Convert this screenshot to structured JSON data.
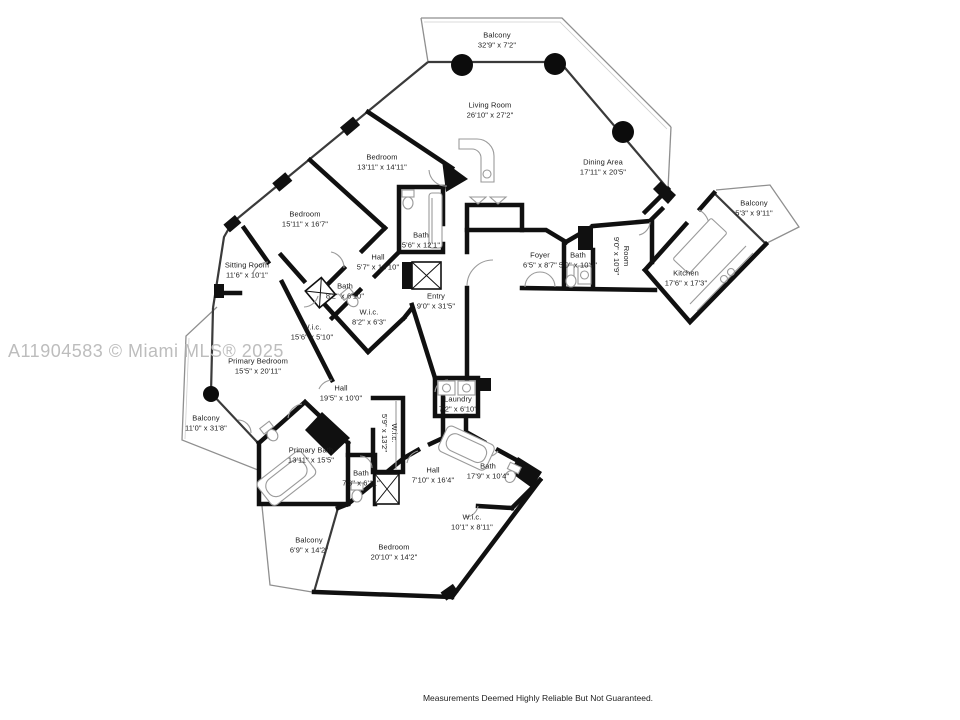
{
  "watermark": "A11904583 © Miami MLS® 2025",
  "disclaimer": "Measurements Deemed Highly Reliable But Not Guaranteed.",
  "colors": {
    "wall": "#101010",
    "window": "#3a3a3a",
    "railing": "#8f8f8f",
    "fixture": "#9a9a9a",
    "watermark": "#bdbdbd"
  },
  "rooms": [
    {
      "name": "Balcony",
      "dims": "32'9\" x 7'2\""
    },
    {
      "name": "Living Room",
      "dims": "26'10\" x 27'2\""
    },
    {
      "name": "Dining Area",
      "dims": "17'11\" x 20'5\""
    },
    {
      "name": "Bedroom",
      "dims": "13'11\" x 14'11\""
    },
    {
      "name": "Bedroom",
      "dims": "15'11\" x 16'7\""
    },
    {
      "name": "Bath",
      "dims": "5'6\" x 12'1\""
    },
    {
      "name": "Hall",
      "dims": "5'7\" x 13'10\""
    },
    {
      "name": "Sitting Room",
      "dims": "11'6\" x 10'1\""
    },
    {
      "name": "Bath",
      "dims": "8'2\" x 6'10\""
    },
    {
      "name": "W.i.c.",
      "dims": "8'2\" x 6'3\""
    },
    {
      "name": "W.i.c.",
      "dims": "15'6\" x 5'10\""
    },
    {
      "name": "Foyer",
      "dims": "6'5\" x 8'7\""
    },
    {
      "name": "Bath",
      "dims": "5'0\" x 10'9\""
    },
    {
      "name": "Room",
      "dims": "9'0\" x 10'9\""
    },
    {
      "name": "Kitchen",
      "dims": "17'6\" x 17'3\""
    },
    {
      "name": "Balcony",
      "dims": "5'3\" x 9'11\""
    },
    {
      "name": "Entry",
      "dims": "9'0\" x 31'5\""
    },
    {
      "name": "Primary Bedroom",
      "dims": "15'5\" x 20'11\""
    },
    {
      "name": "Balcony",
      "dims": "11'0\" x 31'8\""
    },
    {
      "name": "Hall",
      "dims": "19'5\" x 10'0\""
    },
    {
      "name": "W.i.c.",
      "dims": "5'9\" x 13'2\""
    },
    {
      "name": "Primary Bath",
      "dims": "13'11\" x 15'5\""
    },
    {
      "name": "Bath",
      "dims": "7'3\" x 6'11\""
    },
    {
      "name": "Laundry",
      "dims": "7'2\" x 6'10\""
    },
    {
      "name": "Hall",
      "dims": "7'10\" x 16'4\""
    },
    {
      "name": "Bath",
      "dims": "17'9\" x 10'4\""
    },
    {
      "name": "W.i.c.",
      "dims": "10'1\" x 8'11\""
    },
    {
      "name": "Bedroom",
      "dims": "20'10\" x 14'2\""
    },
    {
      "name": "Balcony",
      "dims": "6'9\" x 14'2\""
    }
  ]
}
